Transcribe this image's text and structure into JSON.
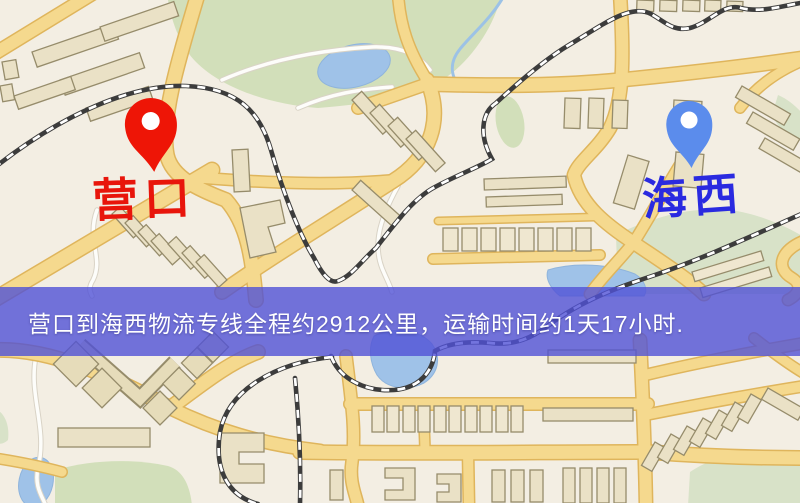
{
  "map": {
    "origin_marker": {
      "label": "营口"
    },
    "destination_marker": {
      "label": "海西"
    },
    "banner": {
      "text": "营口到海西物流专线全程约2912公里，运输时间约1天17小时.",
      "distance_km": "2912",
      "duration": "1天17小时"
    }
  },
  "colors": {
    "origin_pin": "#ee1506",
    "origin_label": "#e8150b",
    "destination_pin": "#5b8cec",
    "destination_label": "#2a2ae0",
    "banner_bg": "#5051d6",
    "banner_text": "#ffffff",
    "map_background": "#f3eee3",
    "road_yellow": "#f5d98e",
    "park_green": "#d2dfba",
    "water_blue": "#9fc2e8",
    "railway": "#3c3c3c",
    "building": "#eae1c6"
  },
  "icons": {
    "origin_pin": "map-pin",
    "destination_pin": "map-pin"
  }
}
